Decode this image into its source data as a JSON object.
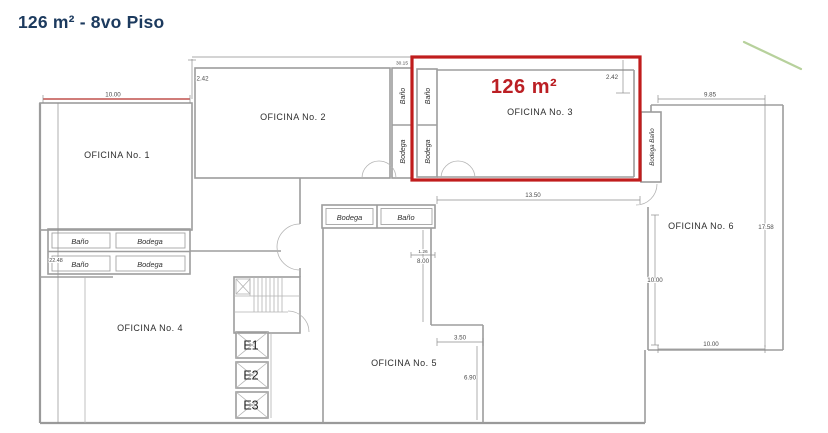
{
  "header": {
    "title": "126 m² - 8vo Piso"
  },
  "highlight": {
    "area_label": "126 m²",
    "color": "#c01d1d"
  },
  "rooms": {
    "oficina1": "OFICINA No. 1",
    "oficina2": "OFICINA No. 2",
    "oficina3": "OFICINA No. 3",
    "oficina4": "OFICINA No. 4",
    "oficina5": "OFICINA No. 5",
    "oficina6": "OFICINA No. 6"
  },
  "service_labels": {
    "bano": "Baño",
    "bodega": "Bodega",
    "bodega_bano": "Bodega Baño"
  },
  "elevators": [
    "E1",
    "E2",
    "E3"
  ],
  "dimensions": {
    "top_left_height": "2.42",
    "top_total": "30.15",
    "top_right_height": "2.42",
    "oficina1_width": "10.00",
    "oficina6_top": "9.85",
    "left_total": "22.48",
    "oficina3_bottom": "13.50",
    "corridor_small": "1.26",
    "corridor_height": "8.00",
    "oficina5_notch": "3.50",
    "oficina5_right": "6.90",
    "right_total": "17.58",
    "oficina6_height": "10.00",
    "oficina6_bottom": "10.00"
  },
  "colors": {
    "title_navy": "#1c3a5e",
    "highlight_red": "#c01d1d",
    "wall_gray": "#9a9a9a",
    "red_dim_line": "#c0504d",
    "accent_green": "#b7d19c"
  }
}
